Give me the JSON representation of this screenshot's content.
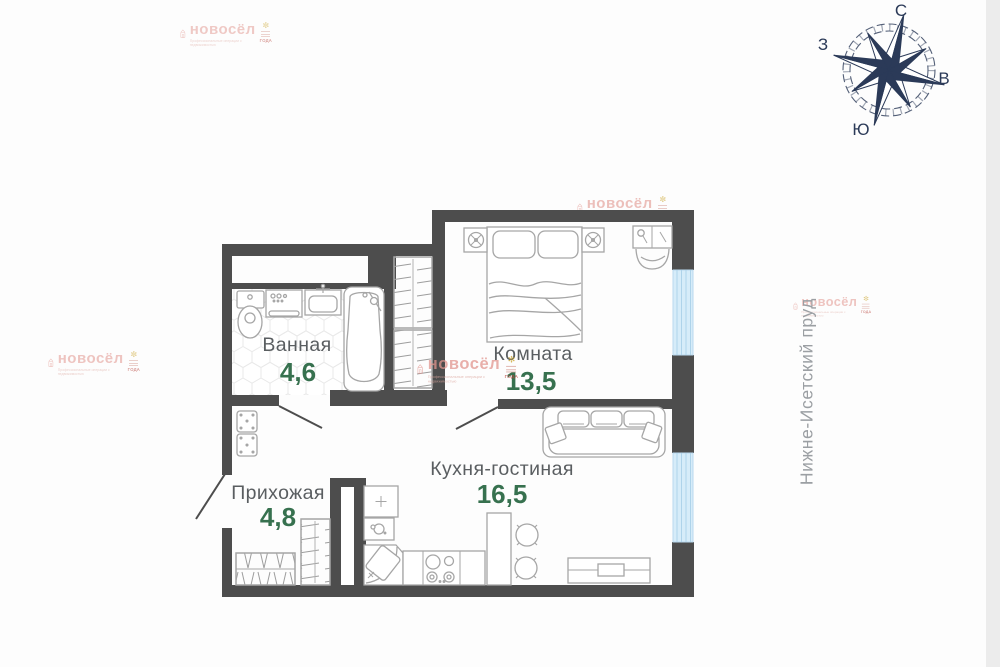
{
  "brand": {
    "name": "новосёл",
    "tagline": "Профессиональные операции с недвижимостью",
    "badge": "ГОДА"
  },
  "compass": {
    "north": "С",
    "south": "Ю",
    "east": "В",
    "west": "З"
  },
  "location_label": "Нижне-Исетский пруд",
  "rooms": [
    {
      "name": "Ванная",
      "area": "4,6"
    },
    {
      "name": "Комната",
      "area": "13,5"
    },
    {
      "name": "Кухня-гостиная",
      "area": "16,5"
    },
    {
      "name": "Прихожая",
      "area": "4,8"
    }
  ],
  "colors": {
    "wall": "#4d4d4d",
    "area_green": "#37714f",
    "label_gray": "#5a5e61",
    "window_blue": "#d6ecf9",
    "compass_navy": "#2b3a58",
    "brand_pink": "#e2968f"
  }
}
